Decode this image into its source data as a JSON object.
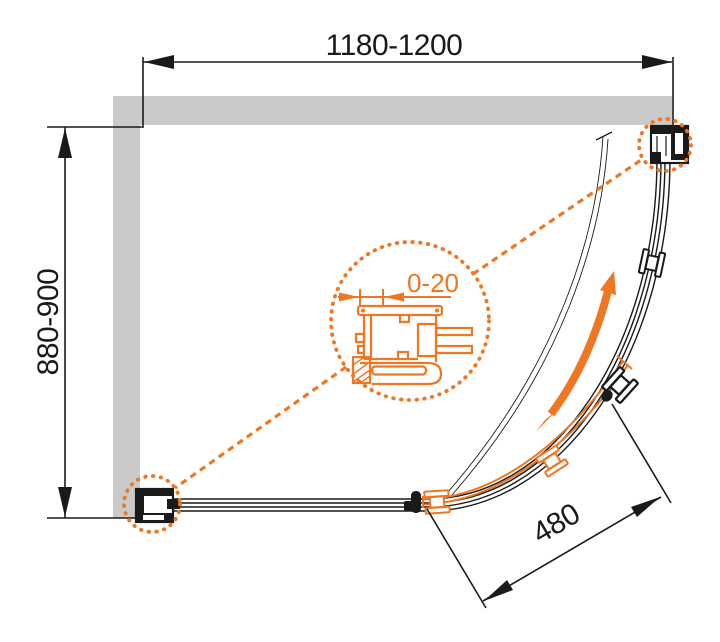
{
  "diagram": {
    "kind": "shower-enclosure-plan-drawing",
    "dimensions": {
      "width_range": "1180-1200",
      "depth_range": "880-900",
      "wall_adjustment_range": "0-20",
      "door_opening": "480"
    },
    "colors": {
      "accent_orange": "#EF7622",
      "line_black": "#1A1A1A",
      "wall_gray": "#CACACA"
    }
  }
}
